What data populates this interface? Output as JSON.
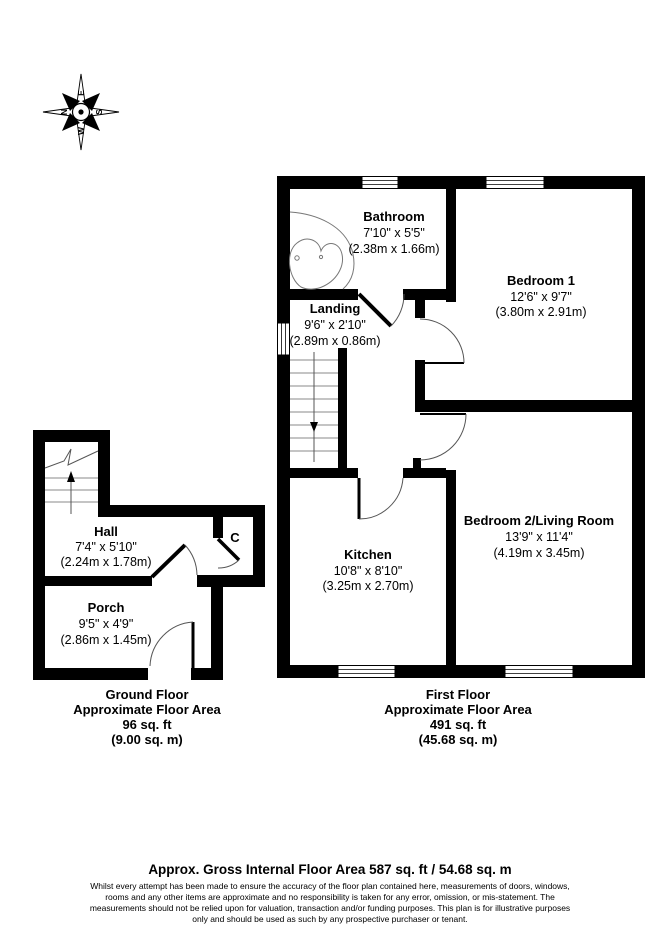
{
  "compass": {
    "north": "N",
    "east": "E",
    "south": "S",
    "west": "W"
  },
  "first_floor": {
    "bathroom": {
      "name": "Bathroom",
      "imperial": "7'10\" x 5'5\"",
      "metric": "(2.38m x 1.66m)"
    },
    "bedroom1": {
      "name": "Bedroom 1",
      "imperial": "12'6\" x 9'7\"",
      "metric": "(3.80m x 2.91m)"
    },
    "landing": {
      "name": "Landing",
      "imperial": "9'6\" x 2'10\"",
      "metric": "(2.89m x 0.86m)"
    },
    "kitchen": {
      "name": "Kitchen",
      "imperial": "10'8\" x 8'10\"",
      "metric": "(3.25m x 2.70m)"
    },
    "bedroom2": {
      "name": "Bedroom 2/Living Room",
      "imperial": "13'9\" x 11'4\"",
      "metric": "(4.19m x 3.45m)"
    }
  },
  "ground_floor": {
    "hall": {
      "name": "Hall",
      "imperial": "7'4\" x 5'10\"",
      "metric": "(2.24m x 1.78m)"
    },
    "porch": {
      "name": "Porch",
      "imperial": "9'5\" x 4'9\"",
      "metric": "(2.86m x 1.45m)"
    },
    "cupboard": {
      "label": "C"
    }
  },
  "area_labels": {
    "ground": {
      "floor": "Ground Floor",
      "approx": "Approximate Floor Area",
      "sqft": "96 sq. ft",
      "sqm": "(9.00 sq. m)"
    },
    "first": {
      "floor": "First Floor",
      "approx": "Approximate Floor Area",
      "sqft": "491 sq. ft",
      "sqm": "(45.68 sq. m)"
    }
  },
  "footer": {
    "title": "Approx. Gross Internal Floor Area 587 sq. ft / 54.68 sq. m",
    "disclaimer": [
      "Whilst every attempt has been made to ensure the accuracy of the floor plan contained here, measurements of doors, windows,",
      "rooms and any other items are approximate and no responsibility is taken for any error, omission, or mis-statement. The",
      "measurements should not be relied upon for valuation, transaction and/or funding purposes. This plan is for illustrative purposes",
      "only and should be used as such by any prospective purchaser or tenant."
    ]
  },
  "colors": {
    "wall": "#000000",
    "background": "#ffffff",
    "text": "#000000"
  }
}
